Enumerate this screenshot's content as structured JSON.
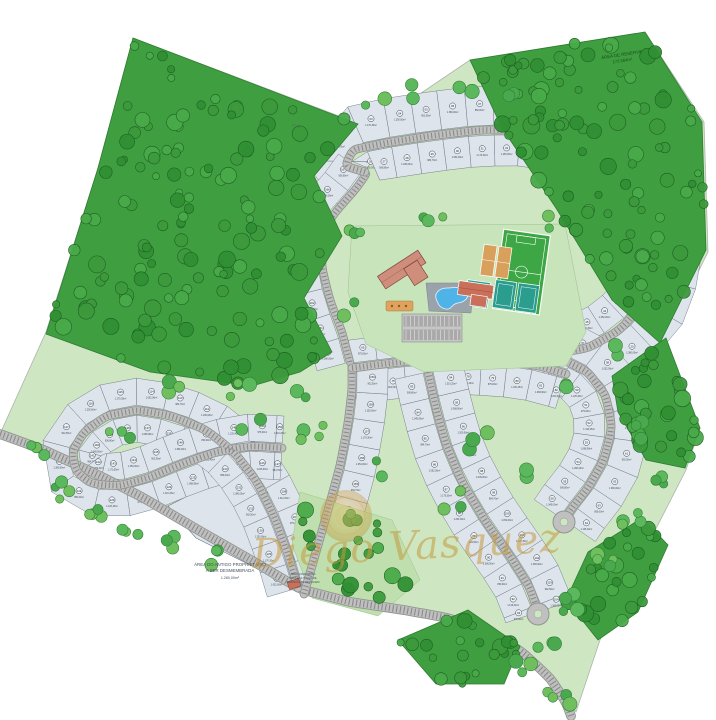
{
  "map_labels": {
    "reserve_area_line1": "ÁREA DE RESERVA",
    "reserve_area_line2": "172.564m²",
    "old_owner_line1": "ÁREA DO ANTIGO PROPRIETÁRIO",
    "old_owner_line2": "A SER DESMEMBRADA",
    "old_owner_area": "1.280,00m²",
    "condo_area_line1": "ÁREA CONDOMÍNIO",
    "condo_area_line2": "CESSÃO A TÍTULO DE",
    "condo_area_line3": "SERVIDÃO DE PASSAGEM",
    "boundary_mark": "LT 02"
  },
  "watermark": {
    "name": "Diego Vasquez"
  },
  "lots": {
    "start_number": 1,
    "area_samples": [
      "1.045,00m²",
      "984,70m²",
      "1.052,00m²",
      "1.170,30m²",
      "1.250,00m²",
      "902,50m²",
      "1.380,00m²",
      "850,00m²",
      "1.125,40m²",
      "975,00m²",
      "1.310,25m²",
      "1.068,90m²",
      "1.200,00m²",
      "936,80m²"
    ]
  },
  "palette": {
    "forest_green": "#3f9e3f",
    "forest_edge": "#2e7d32",
    "light_green": "#cfe6c2",
    "bosque_green": "#bfe0ae",
    "lot_fill": "#dde4ec",
    "lot_line": "#6b7580",
    "road_gray": "#c0c0c0",
    "road_edge": "#8f968f",
    "road_tick": "#8a8a8a",
    "pool_blue": "#4fb3e8",
    "field_green": "#3da645",
    "clay_orange": "#d9a05c",
    "court_teal": "#2a9d8f",
    "roof_red": "#c96f5a",
    "roof_pink": "#cf8d7c",
    "watermark_gold": "#c49a3f"
  }
}
